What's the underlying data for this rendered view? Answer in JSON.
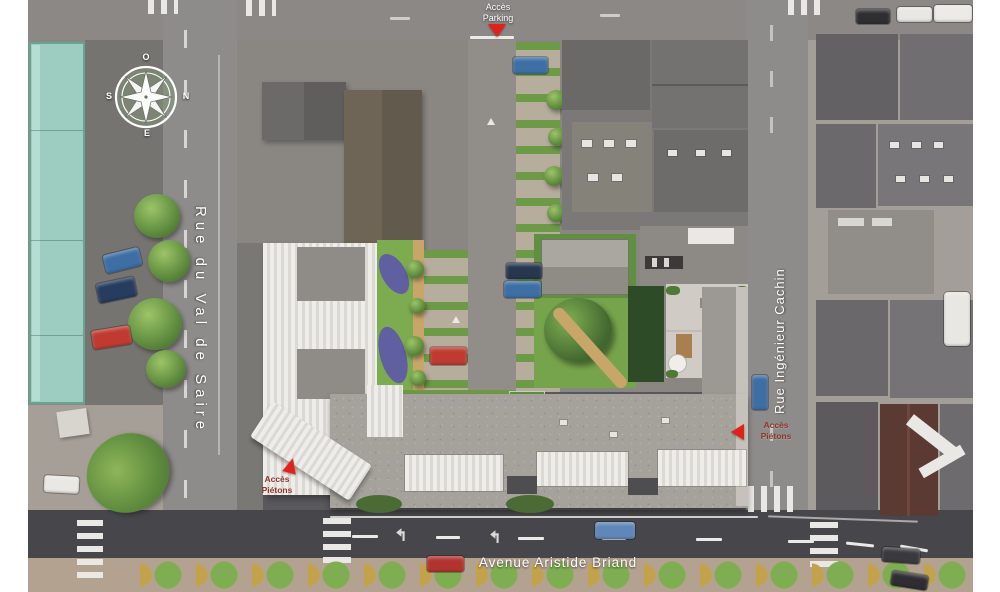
{
  "streets": {
    "left": "Rue du Val de Saire",
    "right": "Rue Ingénieur Cachin",
    "bottom": "Avenue Aristide Briand"
  },
  "access": {
    "parking": {
      "line1": "Accès",
      "line2": "Parking"
    },
    "pedestrian_left": {
      "line1": "Accès",
      "line2": "Piétons"
    },
    "pedestrian_right": {
      "line1": "Accès",
      "line2": "Piétons"
    }
  },
  "compass": {
    "north": "N",
    "south": "S",
    "east": "E",
    "west": "O"
  },
  "colors": {
    "access_arrow_red": "#e2211c",
    "street_label_white": "#ffffff",
    "pedestrian_label_red": "#8f352b",
    "asphalt": "#8e8c8a",
    "avenue_asphalt": "#47474b",
    "teal_building": "#9ccdc0",
    "project_roof_white": "#e8e7e4",
    "project_roof_gray": "#a5a29b",
    "garden_green": "#7cab50",
    "terrace_gray": "#d0ccc5"
  }
}
